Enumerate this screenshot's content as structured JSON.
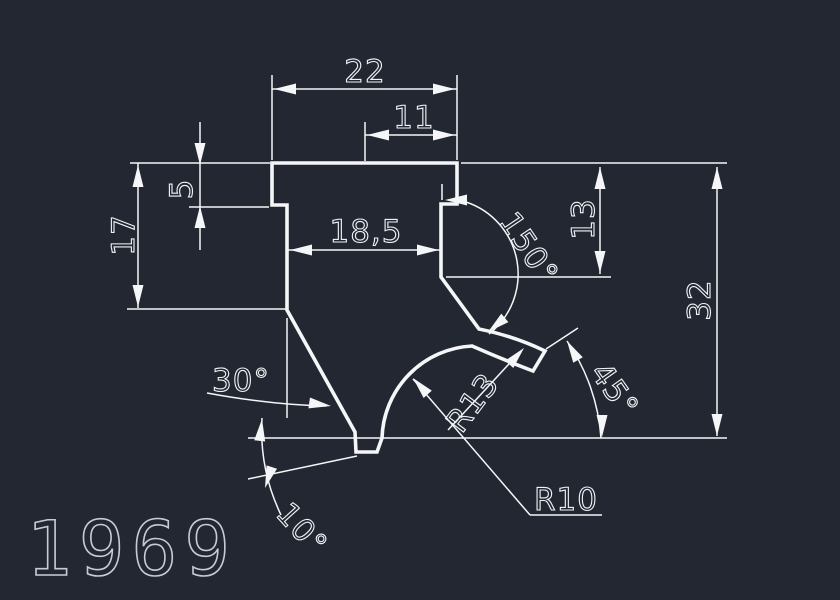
{
  "drawing": {
    "part_number": "1969",
    "colors": {
      "background": "#222731",
      "line": "#f4f6f8",
      "part_number": "#c6ccd4"
    },
    "dimensions": {
      "top_width": "22",
      "top_inner_width": "11",
      "step_height": "5",
      "left_height": "17",
      "stem_width": "18,5",
      "right_upper_height": "13",
      "total_height": "32"
    },
    "angles": {
      "slope_right": "150°",
      "slope_left": "30°",
      "claw_end": "45°",
      "bottom_notch": "10°"
    },
    "radii": {
      "claw": "R13",
      "throat": "R10"
    }
  }
}
